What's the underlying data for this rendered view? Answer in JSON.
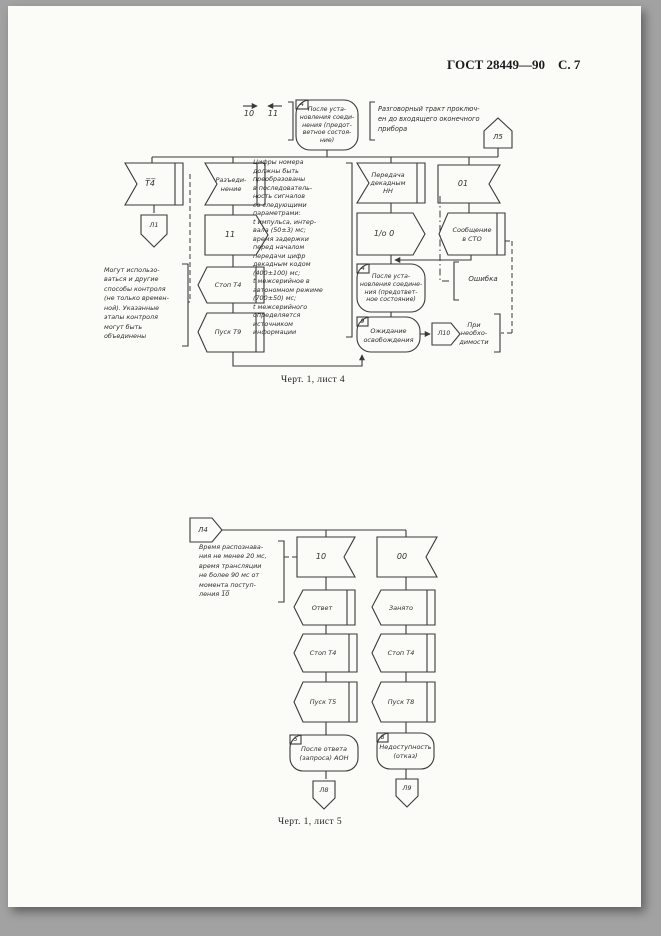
{
  "header": {
    "standard": "ГОСТ 28449—90",
    "page": "С.  7"
  },
  "c1": {
    "sig10": "10",
    "sig11": "11",
    "block4a_num": "4",
    "block4a_text": "После уста-\nновления соеди-\nнения (предот-\nветное состоя-\nние)",
    "note_talk": "Разговорный тракт проключ-\nен до входящего оконечного\nприбора",
    "l5": "Л5",
    "flag_t4": "Т̅4̅",
    "l1": "Л1",
    "flag_razjed": "Разъеди-\nнение",
    "block_11": "11",
    "stop_t4": "Стоп Т4",
    "pusk_t9": "Пуск Т9",
    "note_params": "Цифры номера\nдолжны быть\nпреобразованы\nв последователь-\nность сигналов\nсо следующими\nпараметрами:\nt импульса, интер-\nвала (50±3) мс;\nвремя задержки\nперед началом\nпередачи цифр\nдекадным кодом\n(400±100) мс;\nt межсерийное в\nавтономном режиме\n(700±50) мс;\nt межсерийного\nопределяется\nисточником\nинформации",
    "flag_peredacha": "Передача\nдекадным\nНН",
    "block_1o0": "1/о 0",
    "block4b_num": "4",
    "block4b_text": "После уста-\nновления соедине-\nния (предответ-\nное состояние)",
    "block9_num": "9",
    "block9_text": "Ожидание\nосвобождения",
    "l10": "Л10",
    "note_pri": "При необхо-\nдимости",
    "flag_01": "01",
    "soobshchenie": "Сообщение\nв СТО",
    "oshibka": "Ошибка",
    "note_left": "Могут использо-\nваться и другие\nспособы контроля\n(не только времен-\nной). Указанные\nэтапы контроля\nмогут быть\nобъединены",
    "caption": "Черт. 1, лист 4"
  },
  "c2": {
    "l4": "Л4",
    "note_time": "Время распознава-\nния не менее 20 мс,\nвремя трансляции\nне более 90 мс от\nмомента поступ-\nления 1̅0̅",
    "flag_10": "10",
    "flag_00": "00",
    "otvet": "Ответ",
    "zanyato": "Занято",
    "stop_t4_left": "Стоп Т4",
    "stop_t4_right": "Стоп Т4",
    "pusk_t5": "Пуск Т5",
    "pusk_t8": "Пуск Т8",
    "block5_num": "5",
    "block5_text": "После ответа\n(запроса) АОН",
    "block8_num": "8",
    "block8_text": "Недоступность\n(отказ)",
    "l8": "Л8",
    "l9": "Л9",
    "caption": "Черт. 1, лист 5"
  }
}
